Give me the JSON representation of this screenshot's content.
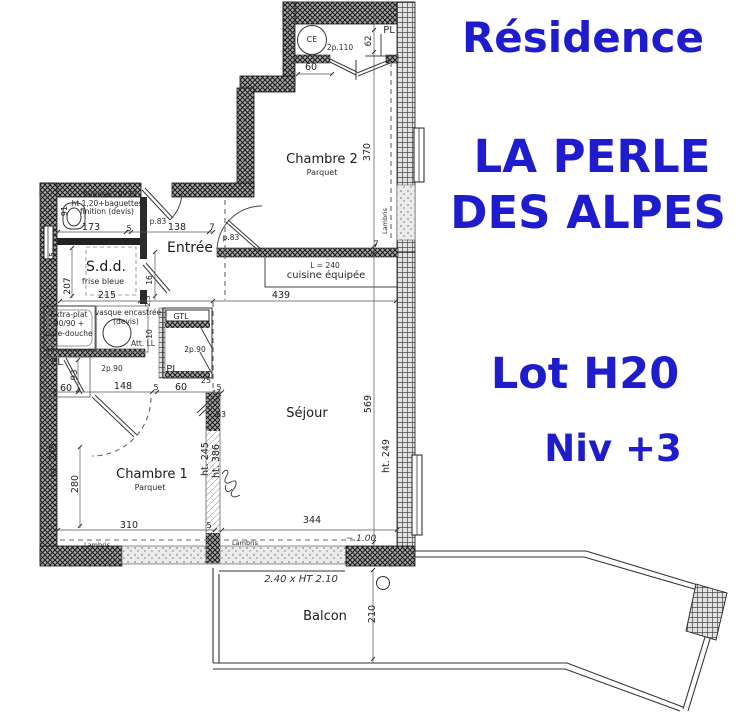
{
  "accent_color": "#1e1ccd",
  "header": {
    "residence": "Résidence",
    "name_line1": "LA PERLE",
    "name_line2": "DES ALPES",
    "lot": "Lot H20",
    "level": "Niv +3"
  },
  "plan": {
    "labels": [
      {
        "id": "room-chambre2",
        "text": "Chambre 2",
        "x": 322,
        "y": 163,
        "size": 13,
        "cls": "room"
      },
      {
        "id": "floor-chambre2",
        "text": "Parquet",
        "x": 322,
        "y": 175,
        "size": 8,
        "cls": "note"
      },
      {
        "id": "room-entree",
        "text": "Entrée",
        "x": 190,
        "y": 252,
        "size": 14,
        "cls": "room"
      },
      {
        "id": "room-sdd",
        "text": "S.d.d.",
        "x": 106,
        "y": 271,
        "size": 14,
        "cls": "room"
      },
      {
        "id": "note-frise-bleue",
        "text": "frise bleue",
        "x": 103,
        "y": 284,
        "size": 8,
        "cls": "note"
      },
      {
        "id": "room-chambre1",
        "text": "Chambre 1",
        "x": 152,
        "y": 478,
        "size": 13,
        "cls": "room"
      },
      {
        "id": "floor-chambre1",
        "text": "Parquet",
        "x": 150,
        "y": 490,
        "size": 8,
        "cls": "note"
      },
      {
        "id": "room-sejour",
        "text": "Séjour",
        "x": 307,
        "y": 417,
        "size": 13,
        "cls": "room"
      },
      {
        "id": "room-balcon",
        "text": "Balcon",
        "x": 325,
        "y": 620,
        "size": 13,
        "cls": "room"
      },
      {
        "id": "note-cuisine",
        "text": "cuisine équipée",
        "x": 326,
        "y": 278,
        "size": 10,
        "cls": "note"
      },
      {
        "id": "note-cuisine-l240",
        "text": "L = 240",
        "x": 325,
        "y": 268,
        "size": 7.5,
        "cls": "note"
      },
      {
        "id": "note-faience-1",
        "text": "faïence 20x20",
        "x": 110,
        "y": 197,
        "size": 7.5,
        "cls": "note"
      },
      {
        "id": "note-faience-2",
        "text": "ht 1,20+baguettes",
        "x": 107,
        "y": 206,
        "size": 7.5,
        "cls": "note"
      },
      {
        "id": "note-faience-3",
        "text": "finition (devis)",
        "x": 107,
        "y": 214,
        "size": 7.5,
        "cls": "note"
      },
      {
        "id": "note-extraplat-1",
        "text": "Extra-plat",
        "x": 69,
        "y": 317,
        "size": 7.5,
        "cls": "note"
      },
      {
        "id": "note-extraplat-2",
        "text": "90/90 +",
        "x": 69,
        "y": 326,
        "size": 7.5,
        "cls": "note"
      },
      {
        "id": "note-extraplat-3",
        "text": "pare-douche",
        "x": 69,
        "y": 336,
        "size": 7.5,
        "cls": "note"
      },
      {
        "id": "note-vasque-1",
        "text": "vasque encastrée",
        "x": 128,
        "y": 315,
        "size": 7.5,
        "cls": "note"
      },
      {
        "id": "note-vasque-2",
        "text": "(devis)",
        "x": 126,
        "y": 324,
        "size": 7.5,
        "cls": "note"
      },
      {
        "id": "note-gtl",
        "text": "GTL",
        "x": 181,
        "y": 319,
        "size": 8,
        "cls": "note"
      },
      {
        "id": "note-att-ll",
        "text": "Att. LL",
        "x": 143,
        "y": 346,
        "size": 7.5,
        "cls": "note"
      },
      {
        "id": "label-pl-chambre2",
        "text": "PL",
        "x": 389,
        "y": 33,
        "size": 10,
        "cls": "note"
      },
      {
        "id": "label-pl-hall",
        "text": "PL",
        "x": 172,
        "y": 372,
        "size": 10,
        "cls": "note"
      },
      {
        "id": "label-pl-left",
        "text": "PL",
        "x": 57,
        "y": 365,
        "size": 10,
        "cls": "note"
      },
      {
        "id": "door-2p110",
        "text": "2p.110",
        "x": 340,
        "y": 50,
        "size": 7.5,
        "cls": "note"
      },
      {
        "id": "door-2p90-right",
        "text": "2p.90",
        "x": 195,
        "y": 352,
        "size": 7.5,
        "cls": "note"
      },
      {
        "id": "door-2p90-left",
        "text": "2p.90",
        "x": 112,
        "y": 371,
        "size": 7.5,
        "cls": "note"
      },
      {
        "id": "door-p83-sejour",
        "text": "p.83",
        "x": 231,
        "y": 240,
        "size": 7.5,
        "cls": "note"
      },
      {
        "id": "door-p83-sdd",
        "text": "p.83",
        "x": 158,
        "y": 224,
        "size": 7.5,
        "cls": "note"
      },
      {
        "id": "finish-lambris-ch2",
        "text": "Lambris",
        "x": 387,
        "y": 221,
        "size": 6.5,
        "rot": -90,
        "cls": "note"
      },
      {
        "id": "finish-lambris-ch1",
        "text": "Lambris",
        "x": 97,
        "y": 547,
        "size": 6.5,
        "cls": "note"
      },
      {
        "id": "finish-lambris-sejour",
        "text": "Lambris",
        "x": 245,
        "y": 545,
        "size": 6.5,
        "cls": "note"
      },
      {
        "id": "fixture-ce",
        "text": "CE",
        "x": 312,
        "y": 42,
        "size": 8,
        "cls": "note"
      },
      {
        "id": "dim-173",
        "text": "173",
        "x": 91,
        "y": 230,
        "size": 9.5,
        "cls": "dim"
      },
      {
        "id": "dim-5-a",
        "text": "5",
        "x": 129,
        "y": 231,
        "size": 8,
        "cls": "dim"
      },
      {
        "id": "dim-138",
        "text": "138",
        "x": 177,
        "y": 230,
        "size": 9.5,
        "cls": "dim"
      },
      {
        "id": "dim-7-a",
        "text": "7",
        "x": 212,
        "y": 230,
        "size": 8.5,
        "cls": "dim"
      },
      {
        "id": "dim-215",
        "text": "215",
        "x": 107,
        "y": 298,
        "size": 9.5,
        "cls": "dim"
      },
      {
        "id": "dim-439",
        "text": "439",
        "x": 281,
        "y": 298,
        "size": 9.5,
        "cls": "dim"
      },
      {
        "id": "dim-60-ch2",
        "text": "60",
        "x": 311,
        "y": 70,
        "size": 9.5,
        "cls": "dim"
      },
      {
        "id": "dim-62",
        "text": "62",
        "x": 371,
        "y": 41,
        "size": 8.5,
        "rot": -90,
        "cls": "dim"
      },
      {
        "id": "dim-370",
        "text": "370",
        "x": 370,
        "y": 152,
        "size": 9.5,
        "rot": -90,
        "cls": "dim"
      },
      {
        "id": "dim-7-b",
        "text": "7",
        "x": 376,
        "y": 247,
        "size": 8.5,
        "cls": "dim"
      },
      {
        "id": "dim-569",
        "text": "569",
        "x": 371,
        "y": 404,
        "size": 9.5,
        "rot": -90,
        "cls": "dim"
      },
      {
        "id": "dim-ht249",
        "text": "ht. 249",
        "x": 389,
        "y": 456,
        "size": 9.5,
        "rot": -90,
        "cls": "dim"
      },
      {
        "id": "dim-91",
        "text": "91",
        "x": 67,
        "y": 211,
        "size": 8,
        "rot": -90,
        "cls": "dim"
      },
      {
        "id": "dim-55",
        "text": "55",
        "x": 55,
        "y": 257,
        "size": 8,
        "rot": -90,
        "cls": "dim"
      },
      {
        "id": "dim-207",
        "text": "207",
        "x": 70,
        "y": 286,
        "size": 9,
        "rot": -90,
        "cls": "dim"
      },
      {
        "id": "dim-16",
        "text": "16",
        "x": 152,
        "y": 280,
        "size": 7.5,
        "rot": -90,
        "cls": "dim"
      },
      {
        "id": "dim-2-5",
        "text": "2,5",
        "x": 150,
        "y": 301,
        "size": 7,
        "rot": -90,
        "cls": "dim"
      },
      {
        "id": "dim-10",
        "text": "10",
        "x": 152,
        "y": 334,
        "size": 7.5,
        "rot": -90,
        "cls": "dim"
      },
      {
        "id": "dim-93",
        "text": "93",
        "x": 77,
        "y": 375,
        "size": 8.5,
        "rot": -90,
        "cls": "dim"
      },
      {
        "id": "dim-60-b",
        "text": "60",
        "x": 66,
        "y": 391,
        "size": 9.5,
        "cls": "dim"
      },
      {
        "id": "dim-148",
        "text": "148",
        "x": 123,
        "y": 389,
        "size": 9.5,
        "cls": "dim"
      },
      {
        "id": "dim-5-b",
        "text": "5",
        "x": 156,
        "y": 390,
        "size": 8,
        "cls": "dim"
      },
      {
        "id": "dim-60-c",
        "text": "60",
        "x": 181,
        "y": 390,
        "size": 9.5,
        "cls": "dim"
      },
      {
        "id": "dim-25",
        "text": "25",
        "x": 206,
        "y": 383,
        "size": 8,
        "cls": "dim"
      },
      {
        "id": "dim-5-c",
        "text": "5",
        "x": 219,
        "y": 390,
        "size": 8,
        "cls": "dim"
      },
      {
        "id": "dim-83",
        "text": ".83",
        "x": 220,
        "y": 417,
        "size": 7.5,
        "cls": "dim"
      },
      {
        "id": "dim-ht245-right",
        "text": "ht. 245",
        "x": 208,
        "y": 459,
        "size": 9.5,
        "rot": -90,
        "cls": "dim"
      },
      {
        "id": "dim-ht386",
        "text": "ht. 386",
        "x": 219,
        "y": 461,
        "size": 9.5,
        "rot": -90,
        "cls": "dim"
      },
      {
        "id": "dim-ht245-left",
        "text": "ht. 245",
        "x": 56,
        "y": 460,
        "size": 9.5,
        "rot": -90,
        "cls": "dim"
      },
      {
        "id": "dim-280",
        "text": "280",
        "x": 78,
        "y": 484,
        "size": 9.5,
        "rot": -90,
        "cls": "dim"
      },
      {
        "id": "dim-310",
        "text": "310",
        "x": 129,
        "y": 528,
        "size": 9.5,
        "cls": "dim"
      },
      {
        "id": "dim-5-d",
        "text": "5",
        "x": 209,
        "y": 528,
        "size": 8,
        "cls": "dim"
      },
      {
        "id": "dim-344",
        "text": "344",
        "x": 312,
        "y": 523,
        "size": 9.5,
        "cls": "dim"
      },
      {
        "id": "dim-210-balcon",
        "text": "210",
        "x": 375,
        "y": 614,
        "size": 9.5,
        "rot": -90,
        "cls": "dim"
      },
      {
        "id": "hand-note-1",
        "text": "~ 1.00",
        "x": 361,
        "y": 541,
        "size": 9,
        "cls": "hand"
      },
      {
        "id": "hand-note-2",
        "text": "2.40 x HT 2.10",
        "x": 301,
        "y": 582,
        "size": 10,
        "cls": "hand"
      }
    ]
  }
}
